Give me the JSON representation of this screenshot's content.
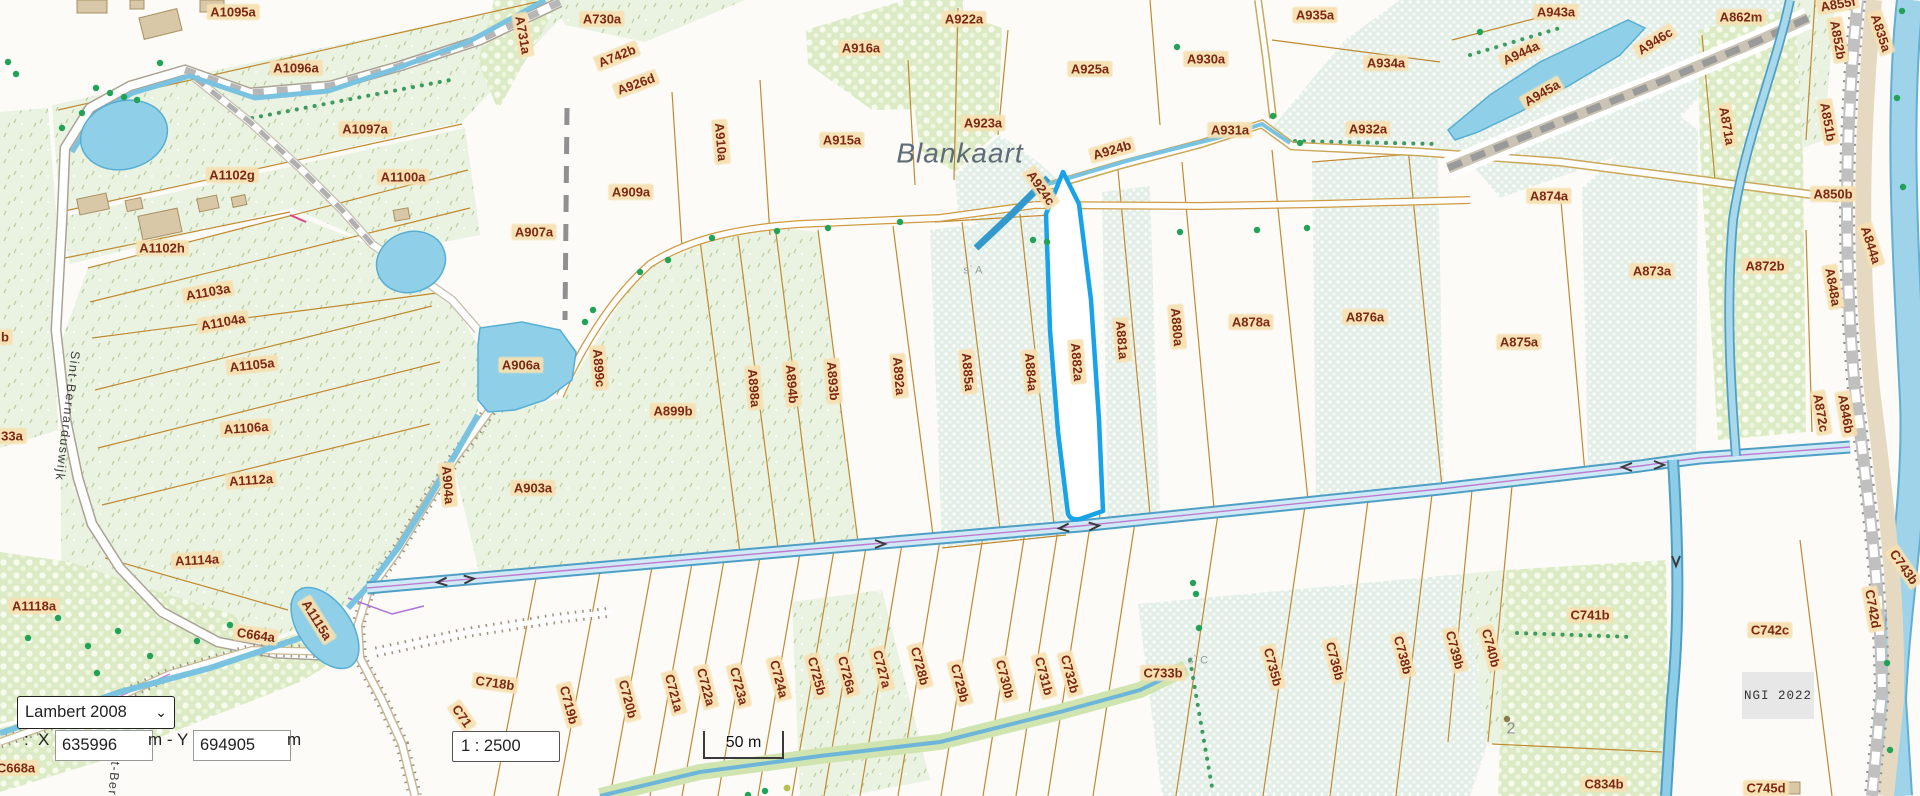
{
  "place_name": "Blankaart",
  "attribution": "NGI 2022",
  "controls": {
    "projection": "Lambert 2008",
    "coord_prefix": ":",
    "x_label": "X",
    "x_value": "635996",
    "mid_label": "m - Y",
    "y_value": "694905",
    "end_label": "m",
    "scale_value": "1 : 2500",
    "scalebar_label": "50 m"
  },
  "colors": {
    "selected_parcel": "#18a2e8",
    "parcel_boundary": "#c08a30",
    "label_text": "#7c2812",
    "label_bg": "#f6e0b0",
    "water": "#8ecde8",
    "ui_border": "#333333"
  },
  "map_labels": [
    {
      "t": "A1095a",
      "x": 233,
      "y": 12
    },
    {
      "t": "A1096a",
      "x": 296,
      "y": 68
    },
    {
      "t": "A1097a",
      "x": 365,
      "y": 129
    },
    {
      "t": "A1102g",
      "x": 232,
      "y": 175
    },
    {
      "t": "A1100a",
      "x": 403,
      "y": 177
    },
    {
      "t": "A1102h",
      "x": 162,
      "y": 248
    },
    {
      "t": "A1103a",
      "x": 208,
      "y": 292,
      "r": -10
    },
    {
      "t": "A1104a",
      "x": 223,
      "y": 322,
      "r": -10
    },
    {
      "t": "A1105a",
      "x": 252,
      "y": 365,
      "r": -6
    },
    {
      "t": "A1106a",
      "x": 246,
      "y": 428,
      "r": -4
    },
    {
      "t": "A1112a",
      "x": 251,
      "y": 480,
      "r": -4
    },
    {
      "t": "A1114a",
      "x": 197,
      "y": 560,
      "r": -3
    },
    {
      "t": "A1118a",
      "x": 34,
      "y": 606
    },
    {
      "t": "A1115a",
      "x": 317,
      "y": 620,
      "r": 58
    },
    {
      "t": "C664a",
      "x": 256,
      "y": 635,
      "r": 8
    },
    {
      "t": "C668a",
      "x": 16,
      "y": 768
    },
    {
      "t": "b",
      "x": 5,
      "y": 337
    },
    {
      "t": "33a",
      "x": 12,
      "y": 436
    },
    {
      "t": "A731a",
      "x": 523,
      "y": 35,
      "r": 80
    },
    {
      "t": "A730a",
      "x": 602,
      "y": 19
    },
    {
      "t": "A742b",
      "x": 617,
      "y": 56,
      "r": -22
    },
    {
      "t": "A926d",
      "x": 636,
      "y": 84,
      "r": -20
    },
    {
      "t": "A916a",
      "x": 861,
      "y": 48
    },
    {
      "t": "A910a",
      "x": 721,
      "y": 142,
      "r": 85
    },
    {
      "t": "A915a",
      "x": 842,
      "y": 140
    },
    {
      "t": "A909a",
      "x": 631,
      "y": 192
    },
    {
      "t": "A907a",
      "x": 534,
      "y": 232
    },
    {
      "t": "A906a",
      "x": 521,
      "y": 365
    },
    {
      "t": "A899c",
      "x": 599,
      "y": 368,
      "r": 85
    },
    {
      "t": "A899b",
      "x": 673,
      "y": 411
    },
    {
      "t": "A903a",
      "x": 533,
      "y": 488
    },
    {
      "t": "A904a",
      "x": 448,
      "y": 485,
      "r": 85
    },
    {
      "t": "A898a",
      "x": 754,
      "y": 388,
      "r": 85
    },
    {
      "t": "A894b",
      "x": 792,
      "y": 384,
      "r": 85
    },
    {
      "t": "A893b",
      "x": 833,
      "y": 381,
      "r": 85
    },
    {
      "t": "A892a",
      "x": 899,
      "y": 376,
      "r": 85
    },
    {
      "t": "A885a",
      "x": 968,
      "y": 372,
      "r": 85
    },
    {
      "t": "A884a",
      "x": 1031,
      "y": 372,
      "r": 85
    },
    {
      "t": "A882a",
      "x": 1077,
      "y": 362,
      "r": 85
    },
    {
      "t": "A881a",
      "x": 1122,
      "y": 340,
      "r": 85
    },
    {
      "t": "A880a",
      "x": 1177,
      "y": 327,
      "r": 85
    },
    {
      "t": "A878a",
      "x": 1251,
      "y": 322
    },
    {
      "t": "A876a",
      "x": 1365,
      "y": 317
    },
    {
      "t": "A875a",
      "x": 1519,
      "y": 342
    },
    {
      "t": "A922a",
      "x": 964,
      "y": 19
    },
    {
      "t": "A923a",
      "x": 983,
      "y": 123
    },
    {
      "t": "A924b",
      "x": 1112,
      "y": 150,
      "r": -16
    },
    {
      "t": "A924c",
      "x": 1041,
      "y": 188,
      "r": 55
    },
    {
      "t": "A925a",
      "x": 1090,
      "y": 69
    },
    {
      "t": "A930a",
      "x": 1206,
      "y": 59
    },
    {
      "t": "A931a",
      "x": 1230,
      "y": 130
    },
    {
      "t": "A932a",
      "x": 1368,
      "y": 129
    },
    {
      "t": "A934a",
      "x": 1386,
      "y": 63
    },
    {
      "t": "A935a",
      "x": 1315,
      "y": 15
    },
    {
      "t": "A943a",
      "x": 1556,
      "y": 12
    },
    {
      "t": "A944a",
      "x": 1521,
      "y": 53,
      "r": -25
    },
    {
      "t": "A945a",
      "x": 1542,
      "y": 93,
      "r": -30
    },
    {
      "t": "A946c",
      "x": 1655,
      "y": 41,
      "r": -32
    },
    {
      "t": "A862m",
      "x": 1741,
      "y": 17
    },
    {
      "t": "A855f",
      "x": 1838,
      "y": 4,
      "r": -10
    },
    {
      "t": "A852b",
      "x": 1838,
      "y": 40,
      "r": 80
    },
    {
      "t": "A835a",
      "x": 1881,
      "y": 33,
      "r": 72
    },
    {
      "t": "A871a",
      "x": 1727,
      "y": 126,
      "r": 80
    },
    {
      "t": "A851b",
      "x": 1828,
      "y": 122,
      "r": 80
    },
    {
      "t": "A850b",
      "x": 1833,
      "y": 194
    },
    {
      "t": "A874a",
      "x": 1549,
      "y": 196
    },
    {
      "t": "A873a",
      "x": 1652,
      "y": 271
    },
    {
      "t": "A872b",
      "x": 1765,
      "y": 266
    },
    {
      "t": "A848a",
      "x": 1833,
      "y": 287,
      "r": 80
    },
    {
      "t": "A844a",
      "x": 1871,
      "y": 245,
      "r": 72
    },
    {
      "t": "A872c",
      "x": 1821,
      "y": 413,
      "r": 80
    },
    {
      "t": "A846b",
      "x": 1846,
      "y": 414,
      "r": 80
    },
    {
      "t": "C718b",
      "x": 495,
      "y": 683,
      "r": 8
    },
    {
      "t": "C71",
      "x": 462,
      "y": 716,
      "r": 55
    },
    {
      "t": "C719b",
      "x": 569,
      "y": 705,
      "r": 75
    },
    {
      "t": "C720b",
      "x": 628,
      "y": 699,
      "r": 75
    },
    {
      "t": "C721a",
      "x": 674,
      "y": 693,
      "r": 75
    },
    {
      "t": "C722a",
      "x": 706,
      "y": 687,
      "r": 75
    },
    {
      "t": "C723a",
      "x": 739,
      "y": 686,
      "r": 75
    },
    {
      "t": "C724a",
      "x": 779,
      "y": 679,
      "r": 75
    },
    {
      "t": "C725b",
      "x": 817,
      "y": 676,
      "r": 75
    },
    {
      "t": "C726a",
      "x": 847,
      "y": 675,
      "r": 75
    },
    {
      "t": "C727a",
      "x": 882,
      "y": 669,
      "r": 75
    },
    {
      "t": "C728b",
      "x": 920,
      "y": 666,
      "r": 75
    },
    {
      "t": "C729b",
      "x": 960,
      "y": 683,
      "r": 75
    },
    {
      "t": "C730b",
      "x": 1005,
      "y": 679,
      "r": 75
    },
    {
      "t": "C731b",
      "x": 1044,
      "y": 676,
      "r": 75
    },
    {
      "t": "C732b",
      "x": 1070,
      "y": 674,
      "r": 75
    },
    {
      "t": "C733b",
      "x": 1163,
      "y": 673
    },
    {
      "t": "C735b",
      "x": 1273,
      "y": 667,
      "r": 75
    },
    {
      "t": "C736b",
      "x": 1335,
      "y": 661,
      "r": 75
    },
    {
      "t": "C738b",
      "x": 1403,
      "y": 655,
      "r": 75
    },
    {
      "t": "C739b",
      "x": 1455,
      "y": 650,
      "r": 75
    },
    {
      "t": "C740b",
      "x": 1491,
      "y": 648,
      "r": 75
    },
    {
      "t": "C741b",
      "x": 1590,
      "y": 615
    },
    {
      "t": "C834b",
      "x": 1604,
      "y": 784
    },
    {
      "t": "C745d",
      "x": 1766,
      "y": 788
    },
    {
      "t": "C742c",
      "x": 1770,
      "y": 630
    },
    {
      "t": "C742d",
      "x": 1873,
      "y": 609,
      "r": 80
    },
    {
      "t": "C743b",
      "x": 1904,
      "y": 567,
      "r": 55
    },
    {
      "t": "3a",
      "x": 281,
      "y": 749
    },
    {
      "t": "Blankaart",
      "x": 960,
      "y": 153,
      "k": "place"
    },
    {
      "t": "Sint-Bernarduswijk",
      "x": 67,
      "y": 416,
      "r": 97,
      "k": "road"
    },
    {
      "t": "t-Bern",
      "x": 113,
      "y": 783,
      "r": 95,
      "k": "road"
    },
    {
      "t": "s` A",
      "x": 973,
      "y": 271,
      "k": "tiny"
    },
    {
      "t": "s` C",
      "x": 1198,
      "y": 661,
      "k": "tiny"
    },
    {
      "t": "2",
      "x": 1511,
      "y": 729,
      "k": "num"
    }
  ],
  "trees": [
    [
      8,
      62
    ],
    [
      16,
      74
    ],
    [
      160,
      63
    ],
    [
      96,
      88
    ],
    [
      110,
      93
    ],
    [
      124,
      97
    ],
    [
      137,
      100
    ],
    [
      82,
      113
    ],
    [
      62,
      128
    ],
    [
      585,
      322
    ],
    [
      593,
      310
    ],
    [
      640,
      272
    ],
    [
      668,
      260
    ],
    [
      712,
      238
    ],
    [
      777,
      231
    ],
    [
      828,
      228
    ],
    [
      900,
      222
    ],
    [
      1180,
      232
    ],
    [
      1257,
      230
    ],
    [
      1307,
      228
    ],
    [
      1177,
      47
    ],
    [
      1273,
      116
    ],
    [
      1300,
      143
    ],
    [
      1033,
      240
    ],
    [
      1047,
      242
    ],
    [
      1193,
      583
    ],
    [
      1196,
      594
    ],
    [
      1199,
      628
    ],
    [
      1902,
      11
    ],
    [
      1897,
      98
    ],
    [
      1903,
      187
    ],
    [
      1480,
      32
    ],
    [
      1887,
      663
    ],
    [
      1890,
      750
    ],
    [
      748,
      795
    ],
    [
      765,
      791
    ],
    [
      28,
      638
    ],
    [
      58,
      618
    ],
    [
      88,
      646
    ],
    [
      118,
      631
    ],
    [
      150,
      656
    ],
    [
      97,
      673
    ],
    [
      197,
      641
    ],
    [
      230,
      625
    ]
  ],
  "special_dots": [
    {
      "x": 787,
      "y": 788,
      "c": "#b8c24a",
      "r": 3.4
    },
    {
      "x": 1507,
      "y": 719,
      "c": "#8a7a4a",
      "r": 3.2
    }
  ],
  "buildings": [
    {
      "x": 77,
      "y": 0,
      "w": 30,
      "h": 13,
      "r": 0
    },
    {
      "x": 130,
      "y": 0,
      "w": 14,
      "h": 9,
      "r": 0
    },
    {
      "x": 200,
      "y": 0,
      "w": 24,
      "h": 12,
      "r": 0
    },
    {
      "x": 141,
      "y": 13,
      "w": 39,
      "h": 22,
      "r": -14
    },
    {
      "x": 78,
      "y": 196,
      "w": 30,
      "h": 16,
      "r": -12
    },
    {
      "x": 126,
      "y": 199,
      "w": 16,
      "h": 11,
      "r": -12
    },
    {
      "x": 198,
      "y": 197,
      "w": 20,
      "h": 13,
      "r": -12
    },
    {
      "x": 140,
      "y": 212,
      "w": 40,
      "h": 24,
      "r": -12
    },
    {
      "x": 232,
      "y": 196,
      "w": 14,
      "h": 10,
      "r": -12
    },
    {
      "x": 394,
      "y": 209,
      "w": 15,
      "h": 11,
      "r": -10
    },
    {
      "x": 1780,
      "y": 782,
      "w": 20,
      "h": 12,
      "r": 0
    }
  ]
}
